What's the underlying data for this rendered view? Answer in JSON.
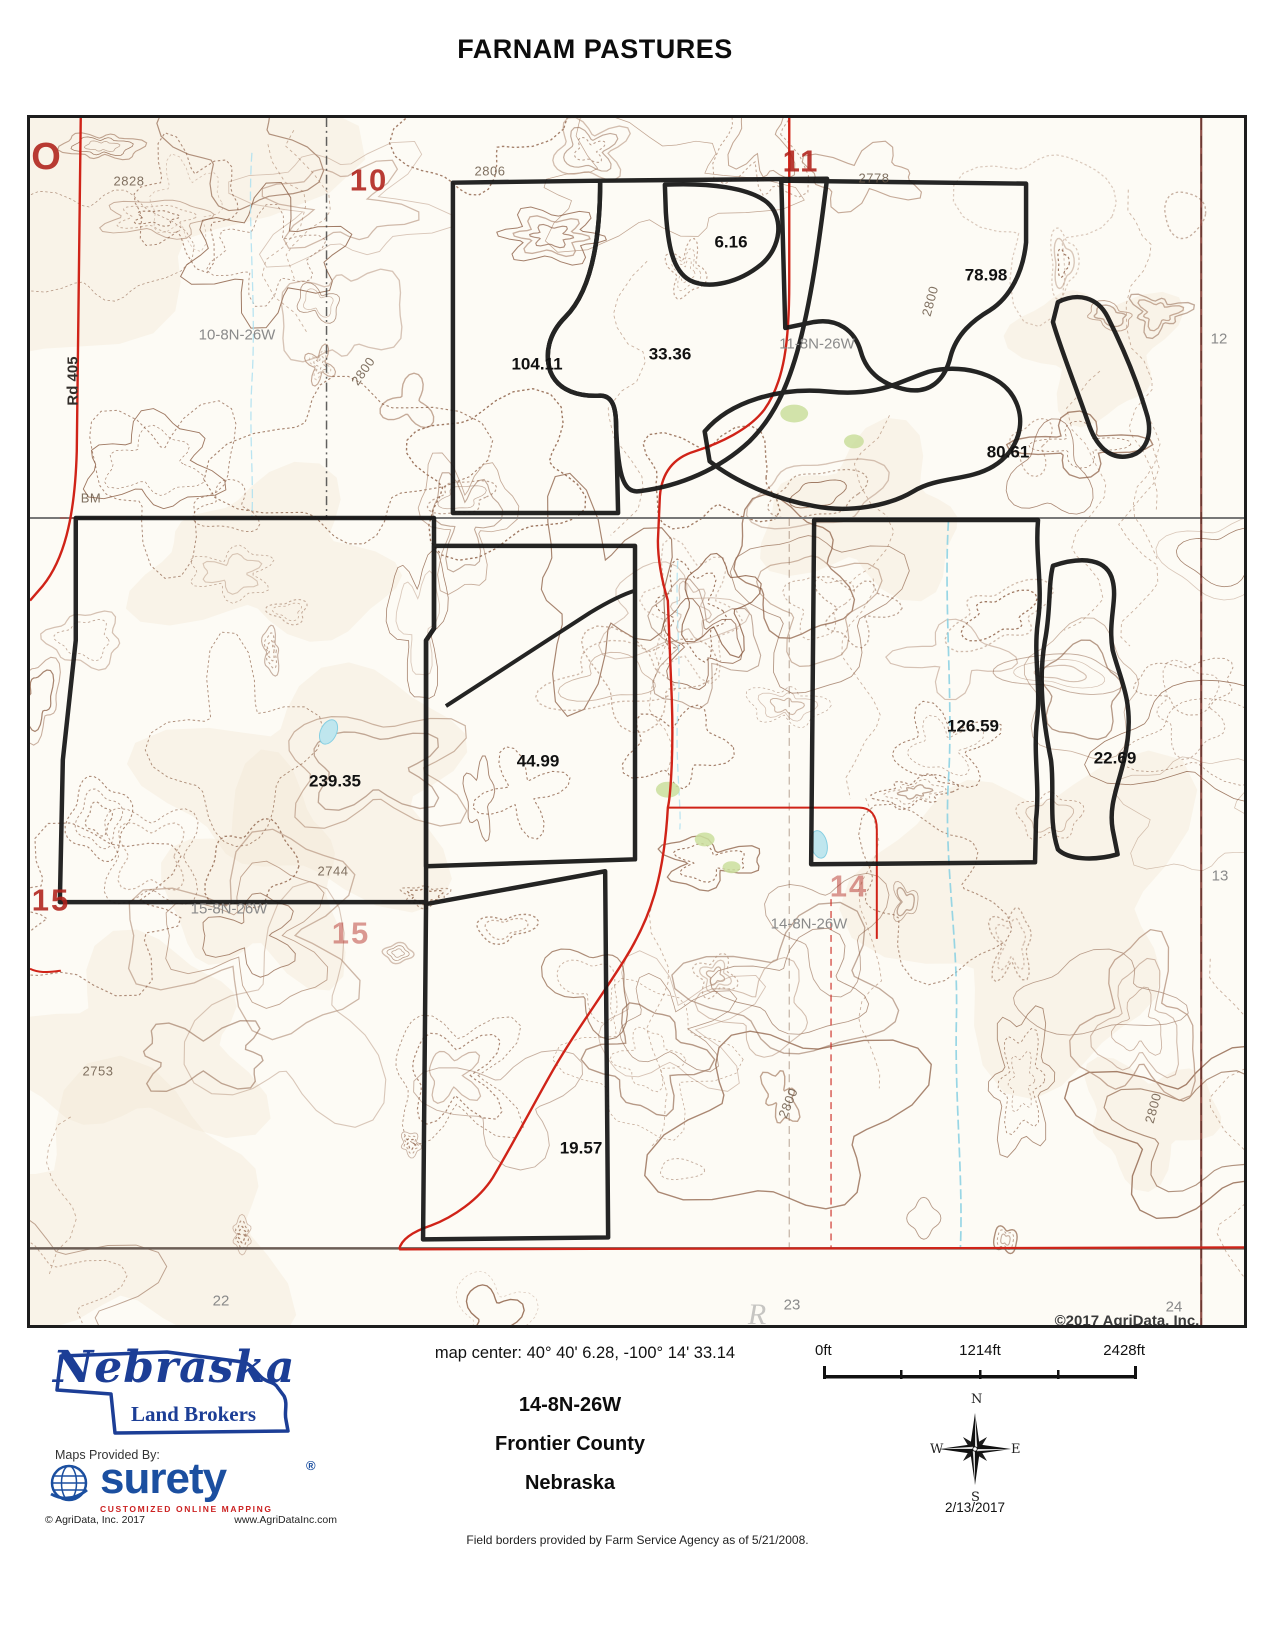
{
  "page": {
    "title": "FARNAM PASTURES",
    "footnote": "Field borders provided by Farm Service Agency as of 5/21/2008."
  },
  "map": {
    "labels": [
      {
        "t": "104.11",
        "x": 507,
        "y": 246,
        "c": "acreage"
      },
      {
        "t": "33.36",
        "x": 640,
        "y": 236,
        "c": "acreage"
      },
      {
        "t": "6.16",
        "x": 701,
        "y": 124,
        "c": "acreage"
      },
      {
        "t": "78.98",
        "x": 956,
        "y": 157,
        "c": "acreage"
      },
      {
        "t": "80.61",
        "x": 978,
        "y": 334,
        "c": "acreage"
      },
      {
        "t": "126.59",
        "x": 943,
        "y": 608,
        "c": "acreage"
      },
      {
        "t": "22.69",
        "x": 1085,
        "y": 640,
        "c": "acreage"
      },
      {
        "t": "44.99",
        "x": 508,
        "y": 643,
        "c": "acreage"
      },
      {
        "t": "239.35",
        "x": 305,
        "y": 663,
        "c": "acreage"
      },
      {
        "t": "19.57",
        "x": 551,
        "y": 1030,
        "c": "acreage"
      },
      {
        "t": "O",
        "x": 17,
        "y": 39,
        "c": "secnum xl"
      },
      {
        "t": "10",
        "x": 339,
        "y": 62,
        "c": "secnum"
      },
      {
        "t": "11",
        "x": 771,
        "y": 43,
        "c": "secnum"
      },
      {
        "t": "15",
        "x": 21,
        "y": 782,
        "c": "secnum"
      },
      {
        "t": "15",
        "x": 321,
        "y": 815,
        "c": "secnum faded"
      },
      {
        "t": "14",
        "x": 819,
        "y": 768,
        "c": "secnum faded"
      },
      {
        "t": "10-8N-26W",
        "x": 207,
        "y": 217,
        "c": "township"
      },
      {
        "t": "11-8N-26W",
        "x": 787,
        "y": 226,
        "c": "township"
      },
      {
        "t": "15-8N-26W",
        "x": 199,
        "y": 791,
        "c": "township"
      },
      {
        "t": "14-8N-26W",
        "x": 779,
        "y": 806,
        "c": "township"
      },
      {
        "t": "12",
        "x": 1189,
        "y": 221,
        "c": "township"
      },
      {
        "t": "13",
        "x": 1190,
        "y": 758,
        "c": "township"
      },
      {
        "t": "22",
        "x": 191,
        "y": 1183,
        "c": "township"
      },
      {
        "t": "23",
        "x": 762,
        "y": 1187,
        "c": "township"
      },
      {
        "t": "24",
        "x": 1144,
        "y": 1189,
        "c": "township"
      },
      {
        "t": "©2017 AgriData, Inc.",
        "x": 1097,
        "y": 1203,
        "c": "mapcopy"
      },
      {
        "t": "2828",
        "x": 99,
        "y": 63,
        "c": "elev"
      },
      {
        "t": "2806",
        "x": 460,
        "y": 53,
        "c": "elev"
      },
      {
        "t": "2778",
        "x": 844,
        "y": 60,
        "c": "elev"
      },
      {
        "t": "2800",
        "x": 900,
        "y": 183,
        "c": "elev",
        "r": -75
      },
      {
        "t": "2800",
        "x": 333,
        "y": 253,
        "c": "elev",
        "r": -55
      },
      {
        "t": "2800",
        "x": 758,
        "y": 985,
        "c": "elev",
        "r": -68
      },
      {
        "t": "2800",
        "x": 1123,
        "y": 990,
        "c": "elev",
        "r": -75
      },
      {
        "t": "2753",
        "x": 68,
        "y": 953,
        "c": "elev"
      },
      {
        "t": "2744",
        "x": 303,
        "y": 753,
        "c": "elev"
      },
      {
        "t": "BM",
        "x": 61,
        "y": 380,
        "c": "elev"
      },
      {
        "t": "R",
        "x": 727,
        "y": 1197,
        "c": "bigletter"
      },
      {
        "t": "Rd 405",
        "x": 43,
        "y": 263,
        "c": "roadlabel",
        "r": -90
      }
    ]
  },
  "footer": {
    "nebraska_logo": {
      "name": "Nebraska",
      "sub": "Land Brokers"
    },
    "maps_provided_by": "Maps Provided By:",
    "surety": {
      "brand": "surety",
      "reg": "®",
      "tagline": "CUSTOMIZED ONLINE MAPPING",
      "copyright": "© AgriData, Inc. 2017",
      "website": "www.AgriDataInc.com"
    },
    "map_center": "map center: 40° 40' 6.28,  -100° 14' 33.14",
    "trs": "14-8N-26W",
    "county": "Frontier County",
    "state": "Nebraska",
    "scale": {
      "d0": "0ft",
      "d1": "1214ft",
      "d2": "2428ft"
    },
    "compass": {
      "n": "N",
      "e": "E",
      "s": "S",
      "w": "W"
    },
    "date": "2/13/2017"
  }
}
